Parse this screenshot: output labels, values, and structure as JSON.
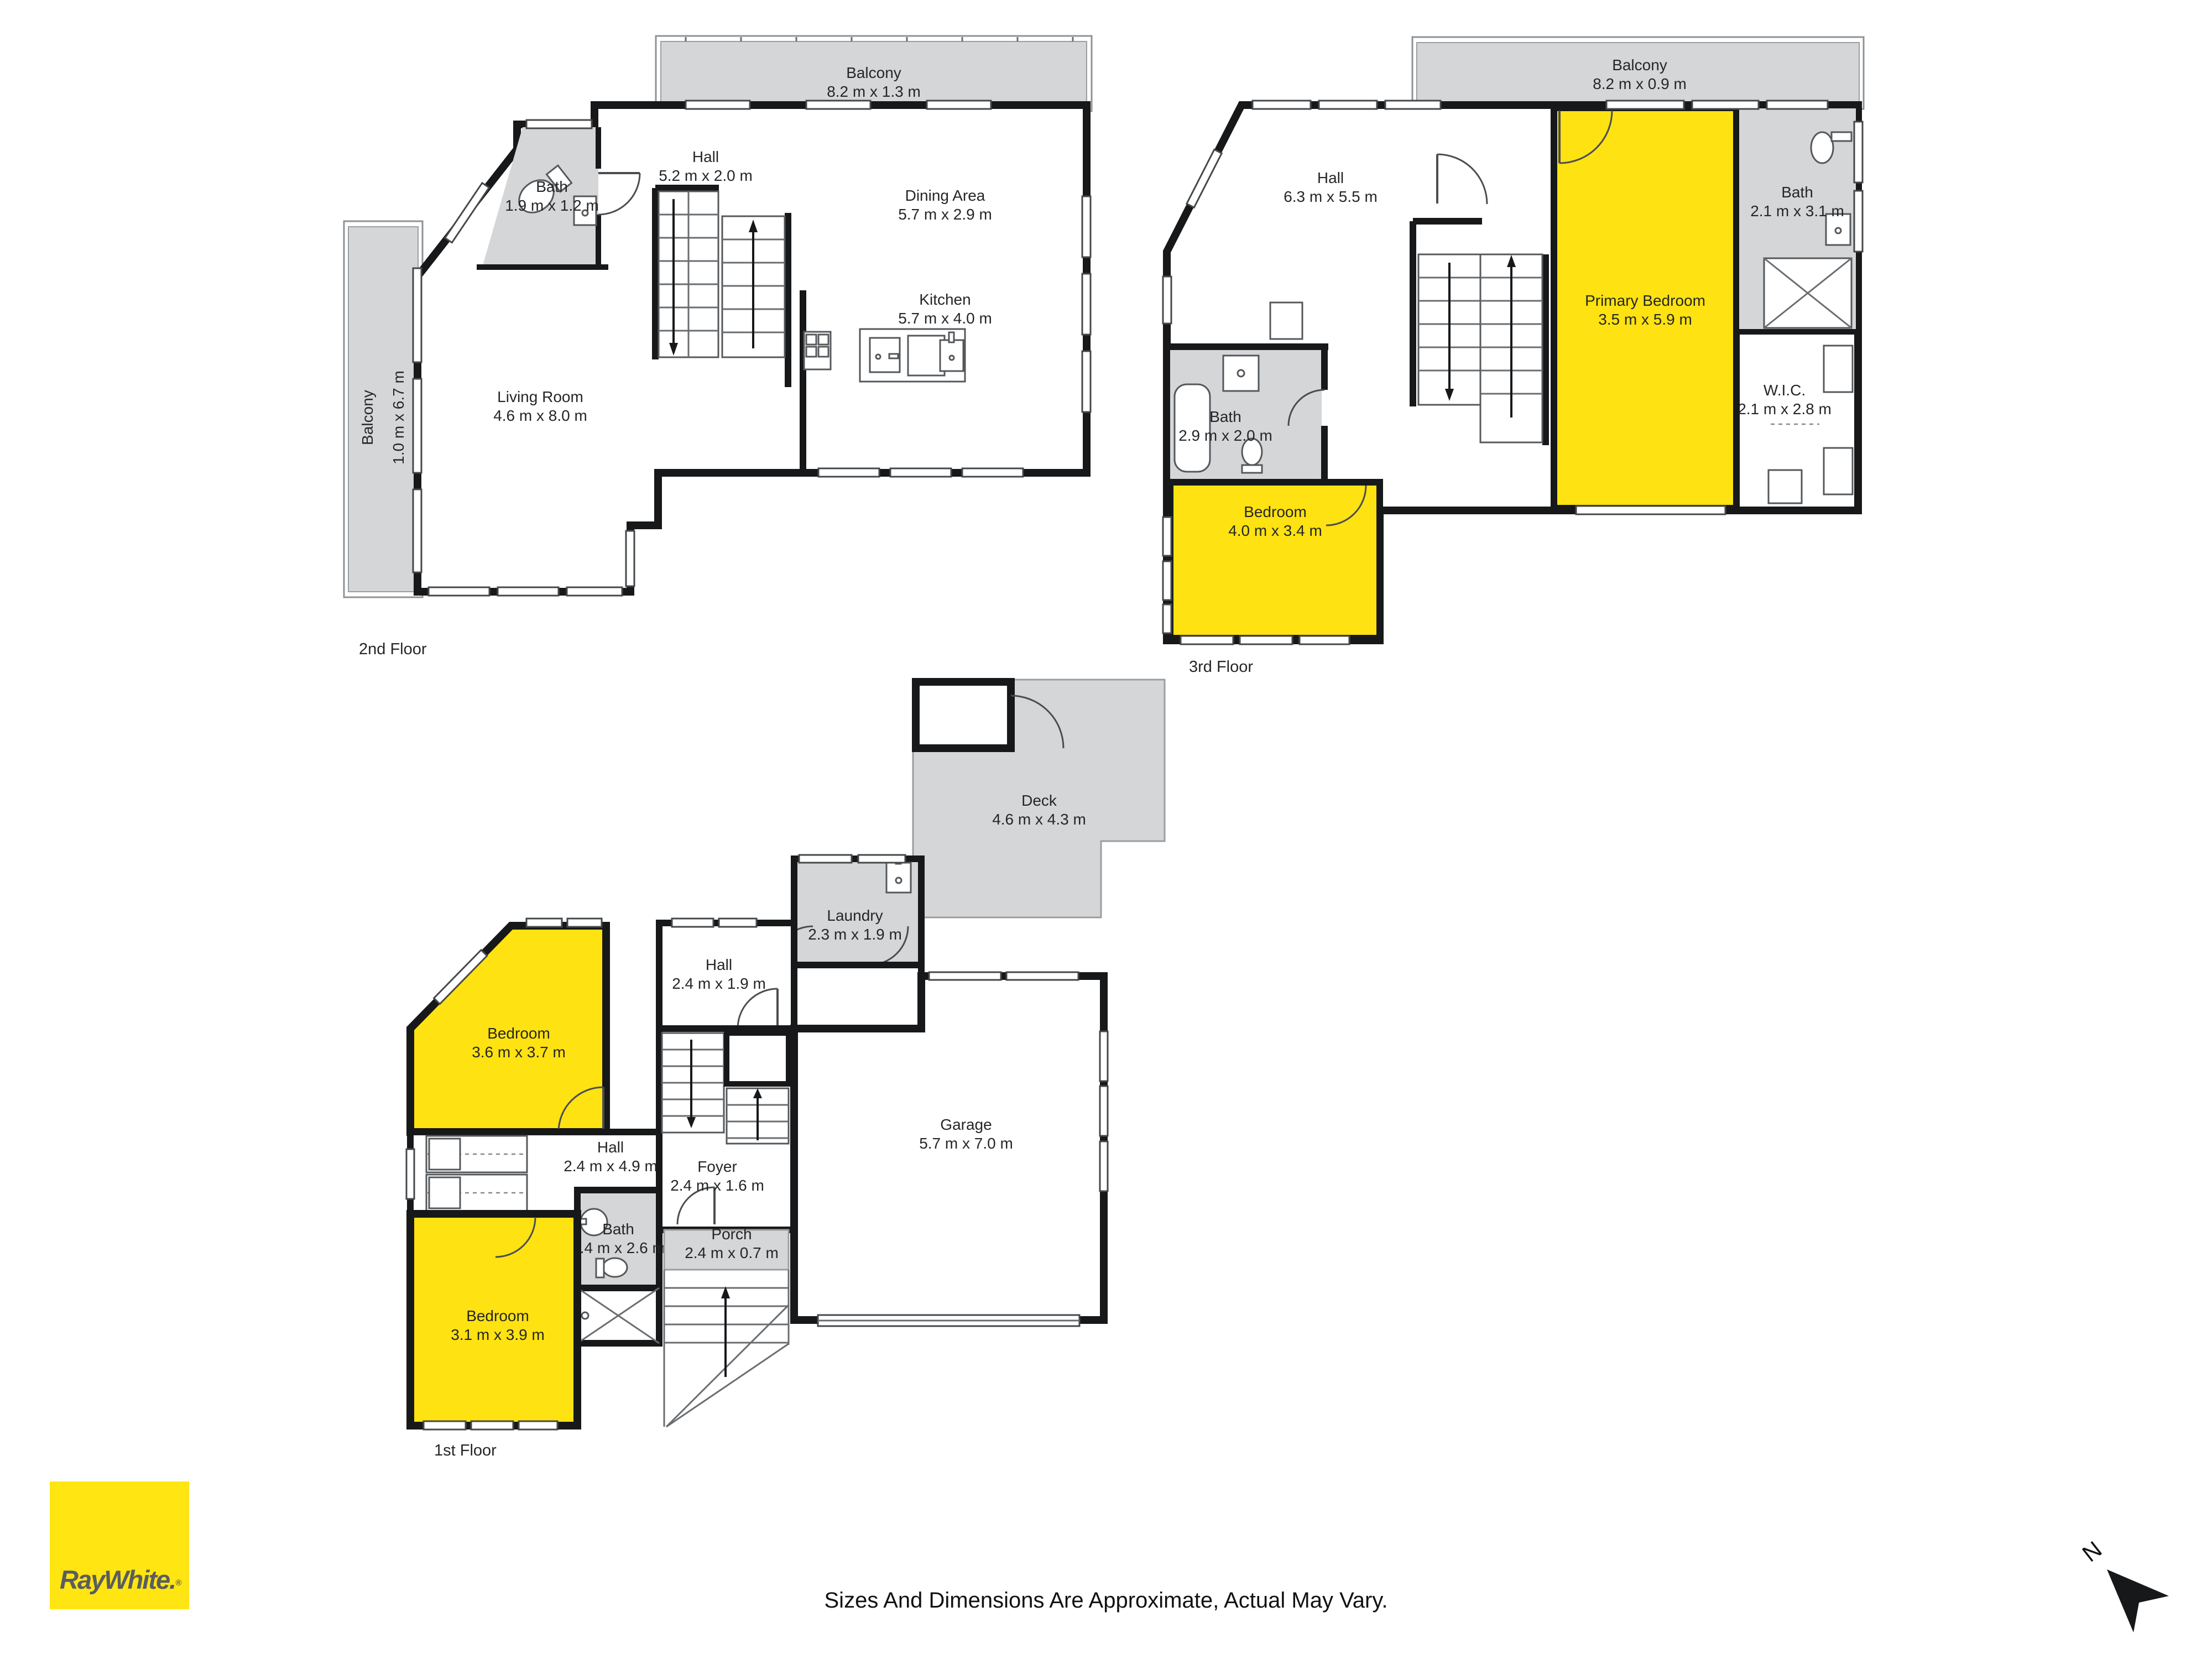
{
  "page": {
    "disclaimer": "Sizes And Dimensions Are Approximate, Actual May Vary.",
    "logo_text": "RayWhite.",
    "logo_registered": "®",
    "north_label": "N"
  },
  "colors": {
    "room_highlight": "#FFE211",
    "outdoor_gray": "#D5D6D8",
    "wall_black": "#17181A",
    "logo_yellow": "#FFE512",
    "logo_text_gray": "#5A5D5F"
  },
  "floors": [
    {
      "title": "2nd Floor",
      "rooms": [
        {
          "name": "Balcony",
          "dims": "8.2 m x 1.3 m"
        },
        {
          "name": "Hall",
          "dims": "5.2 m x 2.0 m"
        },
        {
          "name": "Dining Area",
          "dims": "5.7 m x 2.9 m"
        },
        {
          "name": "Kitchen",
          "dims": "5.7 m x 4.0 m"
        },
        {
          "name": "Bath",
          "dims": "1.9 m x 1.2 m"
        },
        {
          "name": "Living Room",
          "dims": "4.6 m x 8.0 m"
        },
        {
          "name": "Balcony",
          "dims": "1.0 m x 6.7 m"
        }
      ]
    },
    {
      "title": "3rd Floor",
      "rooms": [
        {
          "name": "Balcony",
          "dims": "8.2 m x 0.9 m"
        },
        {
          "name": "Hall",
          "dims": "6.3 m x 5.5 m"
        },
        {
          "name": "Bath",
          "dims": "2.1 m x 3.1 m"
        },
        {
          "name": "Primary Bedroom",
          "dims": "3.5 m x 5.9 m"
        },
        {
          "name": "W.I.C.",
          "dims": "2.1 m x 2.8 m"
        },
        {
          "name": "Bath",
          "dims": "2.9 m x 2.0 m"
        },
        {
          "name": "Bedroom",
          "dims": "4.0 m x 3.4 m"
        }
      ]
    },
    {
      "title": "1st Floor",
      "rooms": [
        {
          "name": "Deck",
          "dims": "4.6 m x 4.3 m"
        },
        {
          "name": "Laundry",
          "dims": "2.3 m x 1.9 m"
        },
        {
          "name": "Hall",
          "dims": "2.4 m x 1.9 m"
        },
        {
          "name": "Bedroom",
          "dims": "3.6 m x 3.7 m"
        },
        {
          "name": "Hall",
          "dims": "2.4 m x 4.9 m"
        },
        {
          "name": "Foyer",
          "dims": "2.4 m x 1.6 m"
        },
        {
          "name": "Garage",
          "dims": "5.7 m x 7.0 m"
        },
        {
          "name": "Bath",
          "dims": "1.4 m x 2.6 m"
        },
        {
          "name": "Porch",
          "dims": "2.4 m x 0.7 m"
        },
        {
          "name": "Bedroom",
          "dims": "3.1 m x 3.9 m"
        }
      ]
    }
  ]
}
